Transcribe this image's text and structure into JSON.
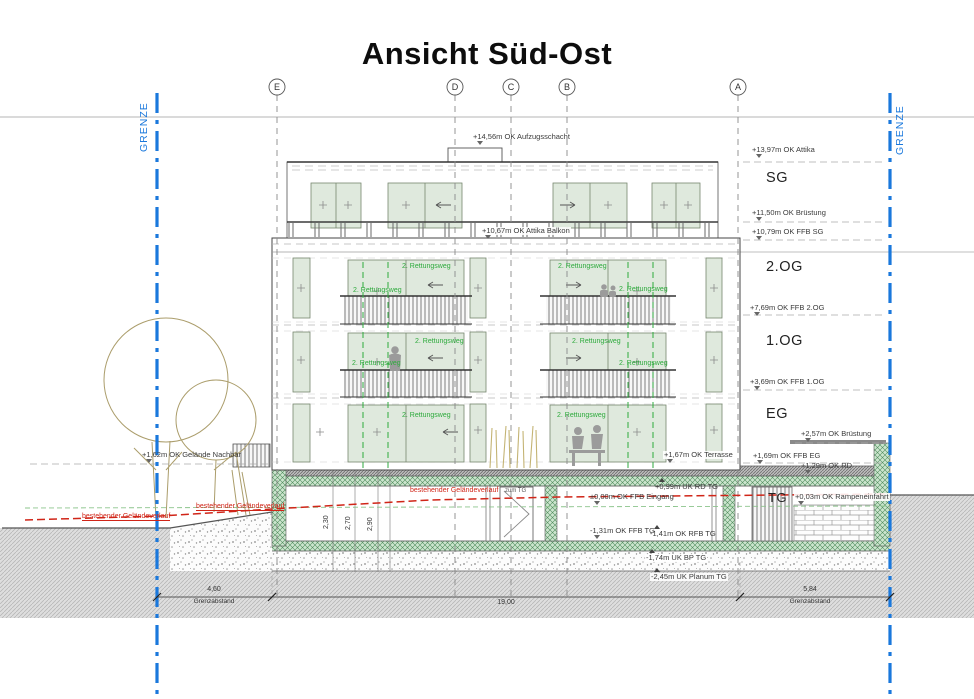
{
  "title": "Ansicht Süd-Ost",
  "boundary": {
    "label": "GRENZE",
    "color": "#1a78dc"
  },
  "grid": [
    {
      "label": "E"
    },
    {
      "label": "D"
    },
    {
      "label": "C"
    },
    {
      "label": "B"
    },
    {
      "label": "A"
    }
  ],
  "floors": {
    "sg": "SG",
    "og2": "2.OG",
    "og1": "1.OG",
    "eg": "EG",
    "tg": "TG"
  },
  "levels": {
    "aufzugsschacht": "+14,56m OK Aufzugsschacht",
    "attika": "+13,97m OK Attika",
    "bruestung_sg": "+11,50m OK Brüstung",
    "ffb_sg": "+10,79m OK FFB SG",
    "attika_balkon": "+10,67m OK Attika Balkon",
    "ffb_2og": "+7,69m OK FFB 2.OG",
    "ffb_1og": "+3,69m OK FFB 1.OG",
    "bruestung_eg": "+2,57m OK Brüstung",
    "ffb_eg": "+1,69m OK FFB EG",
    "rd": "+1,29m OK RD",
    "gelaende_nachbar": "+1,62m OK Gelände Nachbar",
    "terrasse": "+1,67m OK Terrasse",
    "uk_rd_tg": "+0,99m UK RD TG",
    "eingang": "±0,00m OK FFB Eingang",
    "rampeneinfahrt": "+0,03m OK Rampeneinfahrt",
    "ffb_tg": "-1,31m OK FFB TG",
    "rfb_tg": "-1,41m OK RFB TG",
    "uk_bp_tg": "-1,74m UK BP TG",
    "planum_tg": "-2,45m UK Planum TG"
  },
  "terrain": {
    "existing_label": "bestehender Geländeverlauf",
    "color": "#d02518"
  },
  "escape": {
    "label": "2. Rettungsweg",
    "color": "#2daa3c"
  },
  "ramp": {
    "label": "zum TG"
  },
  "dimensions": {
    "left": {
      "value": "4,60",
      "caption": "Grenzabstand"
    },
    "middle": {
      "value": "19,00"
    },
    "right": {
      "value": "5,84",
      "caption": "Grenzabstand"
    },
    "heights": [
      "2,30",
      "2,70",
      "2,90"
    ]
  }
}
